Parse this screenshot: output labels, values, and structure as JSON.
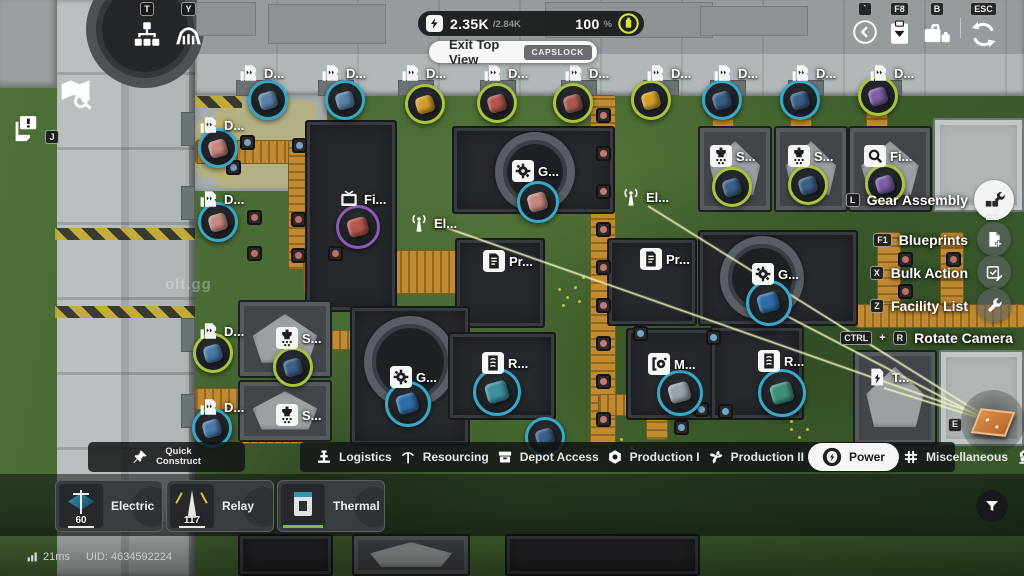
{
  "colors": {
    "accent": "#d9e23b",
    "conveyor": "#c08a30",
    "selected_tab_bg": "#f4f5f4",
    "rings": {
      "cyan": "#38a8c8",
      "lime": "#a9c43a",
      "purple": "#8a5bb5"
    }
  },
  "hud": {
    "power_bar": {
      "current": "2.35K",
      "max": "/2.84K",
      "percent": "100",
      "percent_unit": "%"
    },
    "exit_top_view": {
      "label": "Exit Top View",
      "key": "CAPSLOCK"
    },
    "top_left": [
      {
        "key": "T",
        "icon": "network-icon"
      },
      {
        "key": "Y",
        "icon": "bridge-icon"
      }
    ],
    "top_right": [
      {
        "key": "`",
        "icon": "back-icon"
      },
      {
        "key": "F8",
        "icon": "clipboard-icon"
      },
      {
        "key": "B",
        "icon": "briefcase-icon"
      },
      {
        "key": "ESC",
        "icon": "rotate-icon"
      }
    ],
    "left_icons": {
      "map_icon": "map-search-icon",
      "notice_icon": "notice-icon",
      "notice_key": "J"
    },
    "status": {
      "ping": "21ms",
      "uid": "UID: 4634592224"
    },
    "watermark": "olt.gg"
  },
  "side_menu": {
    "items": [
      {
        "label": "Gear Assembly",
        "key": "L",
        "icon": "assembly",
        "highlight": true
      },
      {
        "label": "Blueprints",
        "key": "F1",
        "icon": "blueprint",
        "highlight": false
      },
      {
        "label": "Bulk Action",
        "key": "X",
        "icon": "bulk",
        "highlight": false
      },
      {
        "label": "Facility List",
        "key": "Z",
        "icon": "wrench",
        "highlight": false
      }
    ],
    "rotate": {
      "label": "Rotate Camera",
      "key1": "CTRL",
      "plus": "+",
      "key2": "R"
    }
  },
  "toolbar": {
    "quick": {
      "line1": "Quick",
      "line2": "Construct",
      "icon": "pin"
    },
    "tabs": [
      {
        "label": "Logistics",
        "icon": "logistics",
        "selected": false,
        "sep_after": true
      },
      {
        "label": "Resourcing",
        "icon": "pickaxe",
        "selected": false,
        "sep_after": true
      },
      {
        "label": "Depot Access",
        "icon": "depot",
        "selected": false,
        "sep_after": true
      },
      {
        "label": "Production I",
        "icon": "nut",
        "selected": false,
        "sep_after": true
      },
      {
        "label": "Production II",
        "icon": "fan",
        "selected": false,
        "sep_after": false
      },
      {
        "label": "Power",
        "icon": "powernet",
        "selected": true,
        "sep_after": false
      },
      {
        "label": "Miscellaneous",
        "icon": "grid",
        "selected": false,
        "sep_after": true
      },
      {
        "label": "Combat",
        "icon": "combat",
        "selected": false,
        "sep_after": false
      }
    ]
  },
  "build_panel": {
    "cards": [
      {
        "name1": "Electric",
        "name2": "Pylon",
        "count": "60",
        "art": "pylon"
      },
      {
        "name1": "Relay",
        "name2": "Tower",
        "count": "117",
        "art": "relay"
      },
      {
        "name1": "Thermal",
        "name2": "Bank",
        "count": "",
        "art": "thermal"
      }
    ],
    "filter_icon": "funnel-icon"
  },
  "map": {
    "markers": [
      {
        "x": 238,
        "y": 62,
        "l": "D...",
        "i": "m-dock"
      },
      {
        "x": 320,
        "y": 62,
        "l": "D...",
        "i": "m-dock"
      },
      {
        "x": 400,
        "y": 62,
        "l": "D...",
        "i": "m-dock"
      },
      {
        "x": 482,
        "y": 62,
        "l": "D...",
        "i": "m-dock"
      },
      {
        "x": 563,
        "y": 62,
        "l": "D...",
        "i": "m-dock"
      },
      {
        "x": 645,
        "y": 62,
        "l": "D...",
        "i": "m-dock"
      },
      {
        "x": 712,
        "y": 62,
        "l": "D...",
        "i": "m-dock"
      },
      {
        "x": 790,
        "y": 62,
        "l": "D...",
        "i": "m-dock"
      },
      {
        "x": 868,
        "y": 62,
        "l": "D...",
        "i": "m-dock"
      },
      {
        "x": 198,
        "y": 114,
        "l": "D...",
        "i": "m-dock"
      },
      {
        "x": 198,
        "y": 188,
        "l": "D...",
        "i": "m-dock"
      },
      {
        "x": 198,
        "y": 320,
        "l": "D...",
        "i": "m-dock"
      },
      {
        "x": 198,
        "y": 396,
        "l": "D...",
        "i": "m-dock"
      },
      {
        "x": 338,
        "y": 188,
        "l": "Fi...",
        "i": "m-monitor"
      },
      {
        "x": 408,
        "y": 212,
        "l": "El...",
        "i": "m-antenna"
      },
      {
        "x": 512,
        "y": 160,
        "l": "G...",
        "i": "m-gear"
      },
      {
        "x": 620,
        "y": 186,
        "l": "El...",
        "i": "m-antenna"
      },
      {
        "x": 710,
        "y": 145,
        "l": "S...",
        "i": "m-crusher"
      },
      {
        "x": 788,
        "y": 145,
        "l": "S...",
        "i": "m-crusher"
      },
      {
        "x": 864,
        "y": 145,
        "l": "Fi...",
        "i": "m-search"
      },
      {
        "x": 483,
        "y": 250,
        "l": "Pr...",
        "i": "m-doc"
      },
      {
        "x": 640,
        "y": 248,
        "l": "Pr...",
        "i": "m-doc"
      },
      {
        "x": 752,
        "y": 263,
        "l": "G...",
        "i": "m-gear"
      },
      {
        "x": 276,
        "y": 327,
        "l": "S...",
        "i": "m-crusher"
      },
      {
        "x": 276,
        "y": 404,
        "l": "S...",
        "i": "m-crusher"
      },
      {
        "x": 390,
        "y": 366,
        "l": "G...",
        "i": "m-gear"
      },
      {
        "x": 482,
        "y": 352,
        "l": "R...",
        "i": "m-refine"
      },
      {
        "x": 648,
        "y": 353,
        "l": "M...",
        "i": "m-machine"
      },
      {
        "x": 758,
        "y": 350,
        "l": "R...",
        "i": "m-refine"
      },
      {
        "x": 866,
        "y": 366,
        "l": "T...",
        "i": "m-power"
      }
    ],
    "items": [
      {
        "x": 268,
        "y": 100,
        "r": "cyan",
        "c": "#5b82a8"
      },
      {
        "x": 345,
        "y": 100,
        "r": "cyan",
        "c": "#5b82a8"
      },
      {
        "x": 425,
        "y": 104,
        "r": "lime",
        "c": "#d2a02a"
      },
      {
        "x": 497,
        "y": 103,
        "r": "lime",
        "c": "#b4574e"
      },
      {
        "x": 573,
        "y": 103,
        "r": "lime",
        "c": "#a85a50"
      },
      {
        "x": 651,
        "y": 100,
        "r": "lime",
        "c": "#d2a02a"
      },
      {
        "x": 722,
        "y": 100,
        "r": "cyan",
        "c": "#3c5f86"
      },
      {
        "x": 800,
        "y": 100,
        "r": "cyan",
        "c": "#3c5f86"
      },
      {
        "x": 878,
        "y": 96,
        "r": "lime",
        "c": "#7b5fa8"
      },
      {
        "x": 218,
        "y": 148,
        "r": "cyan",
        "c": "#c48880"
      },
      {
        "x": 218,
        "y": 222,
        "r": "cyan",
        "c": "#c48880"
      },
      {
        "x": 213,
        "y": 353,
        "r": "lime",
        "c": "#4a79a8"
      },
      {
        "x": 212,
        "y": 428,
        "r": "cyan",
        "c": "#4a79a8"
      },
      {
        "x": 358,
        "y": 227,
        "r": "purple",
        "c": "#b4574e",
        "s": 44
      },
      {
        "x": 538,
        "y": 202,
        "r": "cyan",
        "c": "#c48880",
        "s": 42
      },
      {
        "x": 732,
        "y": 187,
        "r": "lime",
        "c": "#3c5f86"
      },
      {
        "x": 808,
        "y": 185,
        "r": "lime",
        "c": "#3c5f86"
      },
      {
        "x": 885,
        "y": 184,
        "r": "lime",
        "c": "#7b5fa8"
      },
      {
        "x": 293,
        "y": 367,
        "r": "lime",
        "c": "#3c5f86"
      },
      {
        "x": 769,
        "y": 303,
        "r": "cyan",
        "c": "#2e6ea8",
        "s": 46
      },
      {
        "x": 408,
        "y": 404,
        "r": "cyan",
        "c": "#2e6ea8",
        "s": 46
      },
      {
        "x": 497,
        "y": 392,
        "r": "cyan",
        "c": "#3f8f9f",
        "s": 48
      },
      {
        "x": 680,
        "y": 393,
        "r": "cyan",
        "c": "#9aa2a8",
        "s": 46
      },
      {
        "x": 782,
        "y": 393,
        "r": "cyan",
        "c": "#3f8f7a",
        "s": 48
      },
      {
        "x": 545,
        "y": 437,
        "r": "cyan",
        "c": "#3c5f86"
      }
    ],
    "buildings": [
      {
        "x": 305,
        "y": 120,
        "w": 92,
        "h": 192,
        "t": "dark"
      },
      {
        "x": 452,
        "y": 126,
        "w": 163,
        "h": 88,
        "t": "dark",
        "ring": {
          "cx": 83,
          "cy": 46,
          "r": 40
        }
      },
      {
        "x": 698,
        "y": 126,
        "w": 74,
        "h": 86,
        "t": "graydark"
      },
      {
        "x": 774,
        "y": 126,
        "w": 74,
        "h": 86,
        "t": "graydark"
      },
      {
        "x": 848,
        "y": 126,
        "w": 84,
        "h": 86,
        "t": "graydark"
      },
      {
        "x": 933,
        "y": 118,
        "w": 91,
        "h": 94,
        "t": "gray"
      },
      {
        "x": 455,
        "y": 238,
        "w": 90,
        "h": 90,
        "t": "dark"
      },
      {
        "x": 607,
        "y": 238,
        "w": 90,
        "h": 88,
        "t": "dark"
      },
      {
        "x": 698,
        "y": 230,
        "w": 160,
        "h": 96,
        "t": "dark",
        "ring": {
          "cx": 64,
          "cy": 48,
          "r": 42
        }
      },
      {
        "x": 238,
        "y": 300,
        "w": 94,
        "h": 78,
        "t": "graydark"
      },
      {
        "x": 238,
        "y": 380,
        "w": 94,
        "h": 62,
        "t": "graydark"
      },
      {
        "x": 350,
        "y": 306,
        "w": 120,
        "h": 140,
        "t": "dark",
        "ring": {
          "cx": 60,
          "cy": 56,
          "r": 46
        }
      },
      {
        "x": 448,
        "y": 332,
        "w": 108,
        "h": 88,
        "t": "dark"
      },
      {
        "x": 626,
        "y": 328,
        "w": 94,
        "h": 92,
        "t": "dark"
      },
      {
        "x": 710,
        "y": 326,
        "w": 94,
        "h": 94,
        "t": "dark"
      },
      {
        "x": 853,
        "y": 350,
        "w": 84,
        "h": 96,
        "t": "graydark"
      },
      {
        "x": 939,
        "y": 350,
        "w": 85,
        "h": 96,
        "t": "gray"
      },
      {
        "x": 505,
        "y": 534,
        "w": 195,
        "h": 42,
        "t": "dark"
      },
      {
        "x": 352,
        "y": 534,
        "w": 118,
        "h": 42,
        "t": "graydark"
      },
      {
        "x": 238,
        "y": 534,
        "w": 95,
        "h": 42,
        "t": "dark"
      }
    ],
    "conveyors": [
      {
        "x": 195,
        "y": 140,
        "w": 120,
        "h": 24
      },
      {
        "x": 288,
        "y": 140,
        "w": 24,
        "h": 130
      },
      {
        "x": 303,
        "y": 250,
        "w": 164,
        "h": 44
      },
      {
        "x": 590,
        "y": 95,
        "w": 26,
        "h": 350
      },
      {
        "x": 712,
        "y": 95,
        "w": 22,
        "h": 34
      },
      {
        "x": 790,
        "y": 95,
        "w": 22,
        "h": 34
      },
      {
        "x": 866,
        "y": 95,
        "w": 22,
        "h": 34
      },
      {
        "x": 877,
        "y": 232,
        "w": 24,
        "h": 96
      },
      {
        "x": 855,
        "y": 304,
        "w": 170,
        "h": 24
      },
      {
        "x": 940,
        "y": 232,
        "w": 24,
        "h": 74
      },
      {
        "x": 598,
        "y": 394,
        "w": 56,
        "h": 22
      },
      {
        "x": 646,
        "y": 398,
        "w": 22,
        "h": 42
      },
      {
        "x": 330,
        "y": 330,
        "w": 22,
        "h": 20
      },
      {
        "x": 195,
        "y": 388,
        "w": 44,
        "h": 22
      },
      {
        "x": 240,
        "y": 428,
        "w": 92,
        "h": 16
      }
    ],
    "nodes": [
      {
        "x": 596,
        "y": 108,
        "c": "#c47a74"
      },
      {
        "x": 596,
        "y": 146,
        "c": "#c47a74"
      },
      {
        "x": 596,
        "y": 184,
        "c": "#c47a74"
      },
      {
        "x": 596,
        "y": 222,
        "c": "#c47a74"
      },
      {
        "x": 596,
        "y": 260,
        "c": "#c47a74"
      },
      {
        "x": 596,
        "y": 298,
        "c": "#c47a74"
      },
      {
        "x": 596,
        "y": 336,
        "c": "#c47a74"
      },
      {
        "x": 596,
        "y": 374,
        "c": "#c47a74"
      },
      {
        "x": 596,
        "y": 412,
        "c": "#c47a74"
      },
      {
        "x": 240,
        "y": 135,
        "c": "#7d9fc0"
      },
      {
        "x": 292,
        "y": 138,
        "c": "#7d9fc0"
      },
      {
        "x": 226,
        "y": 160,
        "c": "#7d9fc0"
      },
      {
        "x": 247,
        "y": 210,
        "c": "#c0706a"
      },
      {
        "x": 291,
        "y": 212,
        "c": "#c0706a"
      },
      {
        "x": 247,
        "y": 246,
        "c": "#c0706a"
      },
      {
        "x": 291,
        "y": 248,
        "c": "#c0706a"
      },
      {
        "x": 328,
        "y": 246,
        "c": "#c0706a"
      },
      {
        "x": 898,
        "y": 252,
        "c": "#c0706a"
      },
      {
        "x": 898,
        "y": 284,
        "c": "#c0706a"
      },
      {
        "x": 946,
        "y": 252,
        "c": "#c0706a"
      },
      {
        "x": 633,
        "y": 326,
        "c": "#6fa8cf"
      },
      {
        "x": 706,
        "y": 330,
        "c": "#6fa8cf"
      },
      {
        "x": 694,
        "y": 402,
        "c": "#6fa8cf"
      },
      {
        "x": 718,
        "y": 404,
        "c": "#6fa8cf"
      },
      {
        "x": 674,
        "y": 420,
        "c": "#6fa8cf"
      }
    ],
    "paint": [
      {
        "x": 215,
        "y": 100,
        "w": 102,
        "h": 88
      },
      {
        "x": 196,
        "y": 118,
        "w": 40,
        "h": 60
      }
    ],
    "hazards": [
      {
        "x": 55,
        "y": 228,
        "w": 140,
        "h": 12
      },
      {
        "x": 55,
        "y": 306,
        "w": 140,
        "h": 12
      },
      {
        "x": 196,
        "y": 96,
        "w": 46,
        "h": 12
      }
    ],
    "pads": [
      {
        "x": 268,
        "y": 4,
        "w": 118,
        "h": 40
      },
      {
        "x": 545,
        "y": 2,
        "w": 168,
        "h": 36
      },
      {
        "x": 700,
        "y": 6,
        "w": 108,
        "h": 30
      },
      {
        "x": 196,
        "y": 2,
        "w": 60,
        "h": 34
      }
    ],
    "notches_top": [
      238,
      320,
      400,
      482,
      563,
      645,
      712,
      790,
      868
    ],
    "notches_left": [
      112,
      186,
      318,
      394
    ],
    "dots": [
      [
        558,
        288
      ],
      [
        566,
        296
      ],
      [
        574,
        286
      ],
      [
        562,
        304
      ],
      [
        578,
        300
      ],
      [
        582,
        276
      ],
      [
        770,
        296
      ],
      [
        778,
        304
      ],
      [
        786,
        296
      ],
      [
        774,
        312
      ],
      [
        790,
        420
      ],
      [
        620,
        438
      ],
      [
        630,
        446
      ],
      [
        790,
        428
      ],
      [
        798,
        436
      ],
      [
        806,
        428
      ]
    ],
    "beams": [
      [
        988,
        418,
        447,
        228
      ],
      [
        988,
        418,
        648,
        206
      ],
      [
        986,
        420,
        884,
        388
      ],
      [
        990,
        422,
        760,
        302
      ]
    ],
    "ramp": {
      "x": 993,
      "y": 422,
      "key": "E"
    }
  }
}
